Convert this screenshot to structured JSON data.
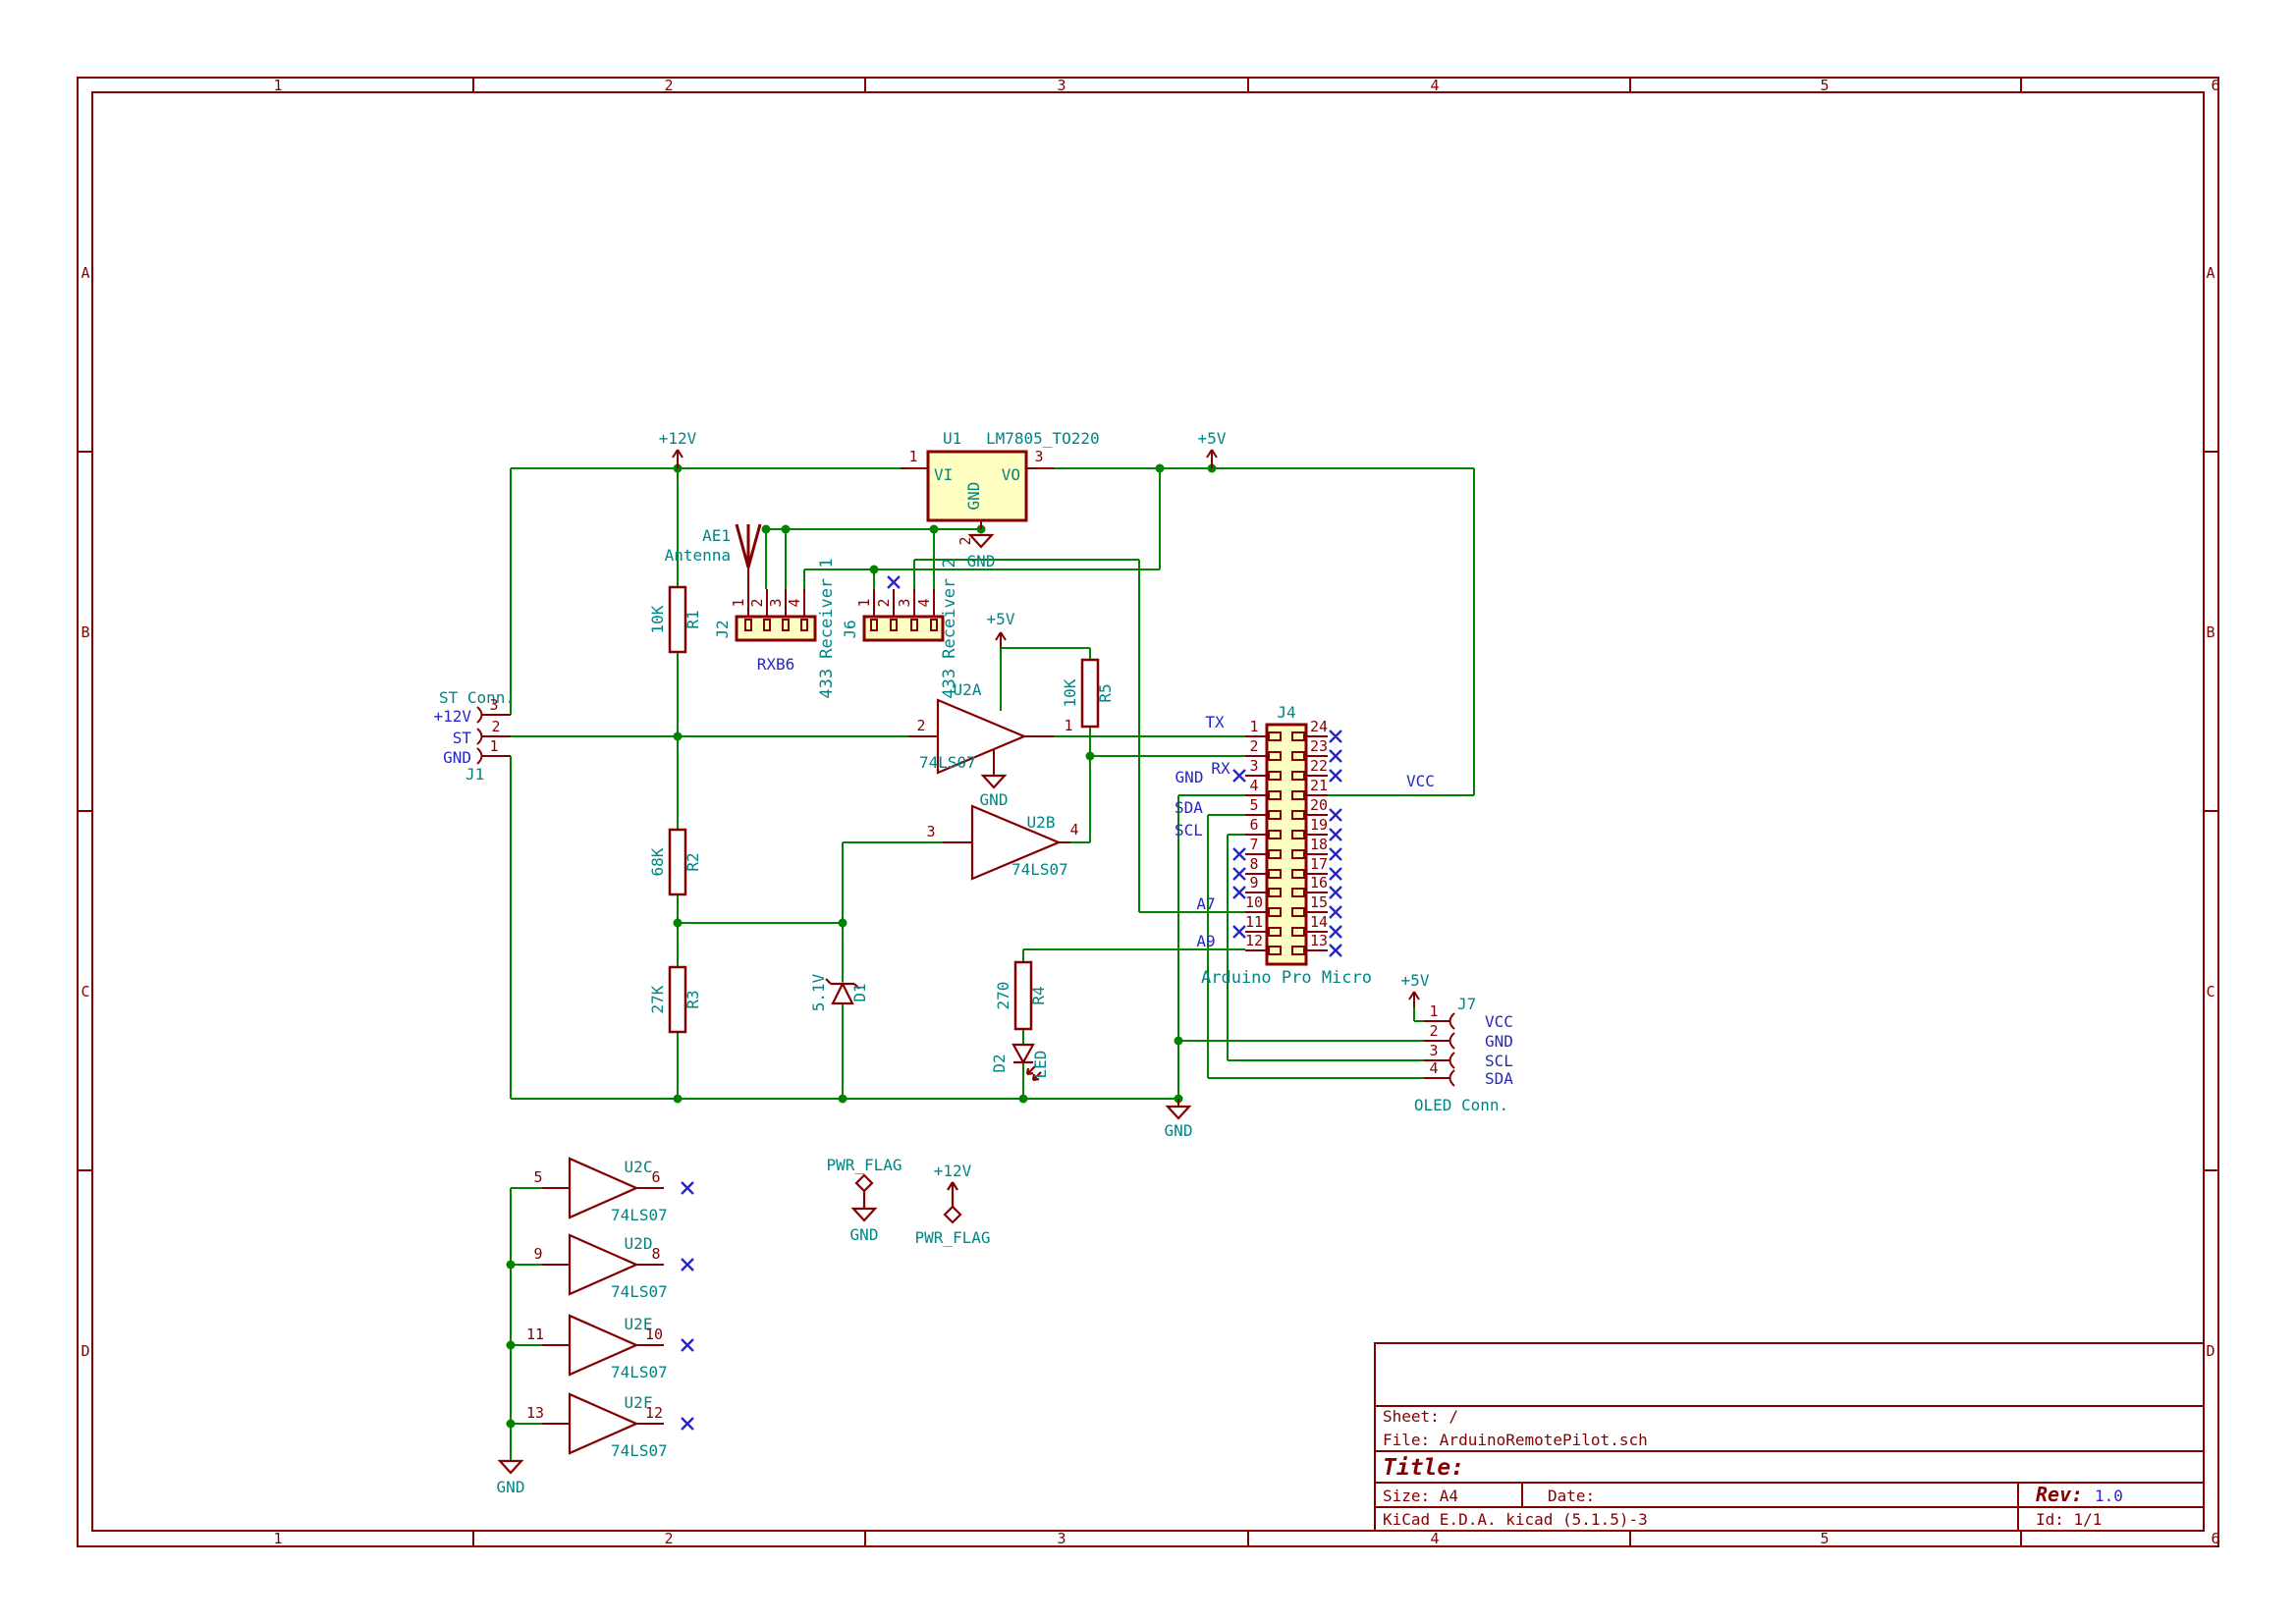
{
  "colors": {
    "wire": "#008400",
    "symbol_outline": "#840000",
    "component_fill": "#FFFFC2",
    "field_text": "#008484",
    "net_label": "#2626C6",
    "frame": "#840000"
  },
  "frame": {
    "columns": [
      "1",
      "2",
      "3",
      "4",
      "5",
      "6"
    ],
    "rows": [
      "A",
      "B",
      "C",
      "D"
    ]
  },
  "title_block": {
    "sheet": "Sheet: /",
    "file": "File: ArduinoRemotePilot.sch",
    "title_label": "Title:",
    "size": "Size: A4",
    "date_label": "Date:",
    "rev_label": "Rev:",
    "rev_value": "1.0",
    "generator": "KiCad E.D.A.  kicad (5.1.5)-3",
    "sheet_id": "Id: 1/1"
  },
  "power": {
    "p12v": "+12V",
    "p5v": "+5V",
    "gnd": "GND",
    "pwr_flag": "PWR_FLAG"
  },
  "net_labels": {
    "tx": "TX",
    "rx": "RX",
    "gnd": "GND",
    "sda": "SDA",
    "scl": "SCL",
    "a7": "A7",
    "a9": "A9",
    "vcc": "VCC"
  },
  "components": {
    "u1": {
      "ref": "U1",
      "value": "LM7805_TO220",
      "pin_vi": "VI",
      "pin_vo": "VO",
      "pin_gnd": "GND",
      "n1": "1",
      "n2": "2",
      "n3": "3"
    },
    "j1": {
      "ref": "J1",
      "value": "ST Conn.",
      "n1": "1",
      "n2": "2",
      "n3": "3",
      "l1": "GND",
      "l2": "ST",
      "l3": "+12V"
    },
    "ae1": {
      "ref": "AE1",
      "value": "Antenna"
    },
    "j2": {
      "ref": "J2",
      "value": "RXB6",
      "desc": "433 Receiver 1",
      "n": [
        "1",
        "2",
        "3",
        "4"
      ]
    },
    "j6": {
      "ref": "J6",
      "desc": "433 Receiver 2",
      "n": [
        "1",
        "2",
        "3",
        "4"
      ]
    },
    "r1": {
      "ref": "R1",
      "value": "10K"
    },
    "r2": {
      "ref": "R2",
      "value": "68K"
    },
    "r3": {
      "ref": "R3",
      "value": "27K"
    },
    "r4": {
      "ref": "R4",
      "value": "270"
    },
    "r5": {
      "ref": "R5",
      "value": "10K"
    },
    "d1": {
      "ref": "D1",
      "value": "5.1V"
    },
    "d2": {
      "ref": "D2",
      "value": "LED"
    },
    "u2": {
      "value": "74LS07",
      "a": {
        "ref": "U2A",
        "pin_in": "2",
        "pin_out": "1"
      },
      "b": {
        "ref": "U2B",
        "pin_in": "3",
        "pin_out": "4"
      },
      "c": {
        "ref": "U2C",
        "pin_in": "5",
        "pin_out": "6"
      },
      "d": {
        "ref": "U2D",
        "pin_in": "9",
        "pin_out": "8"
      },
      "e": {
        "ref": "U2E",
        "pin_in": "11",
        "pin_out": "10"
      },
      "f": {
        "ref": "U2F",
        "pin_in": "13",
        "pin_out": "12"
      }
    },
    "j4": {
      "ref": "J4",
      "value": "Arduino Pro Micro",
      "left": [
        "1",
        "2",
        "3",
        "4",
        "5",
        "6",
        "7",
        "8",
        "9",
        "10",
        "11",
        "12"
      ],
      "right": [
        "24",
        "23",
        "22",
        "21",
        "20",
        "19",
        "18",
        "17",
        "16",
        "15",
        "14",
        "13"
      ]
    },
    "j7": {
      "ref": "J7",
      "value": "OLED Conn.",
      "n": [
        "1",
        "2",
        "3",
        "4"
      ],
      "l": [
        "VCC",
        "GND",
        "SCL",
        "SDA"
      ]
    }
  }
}
